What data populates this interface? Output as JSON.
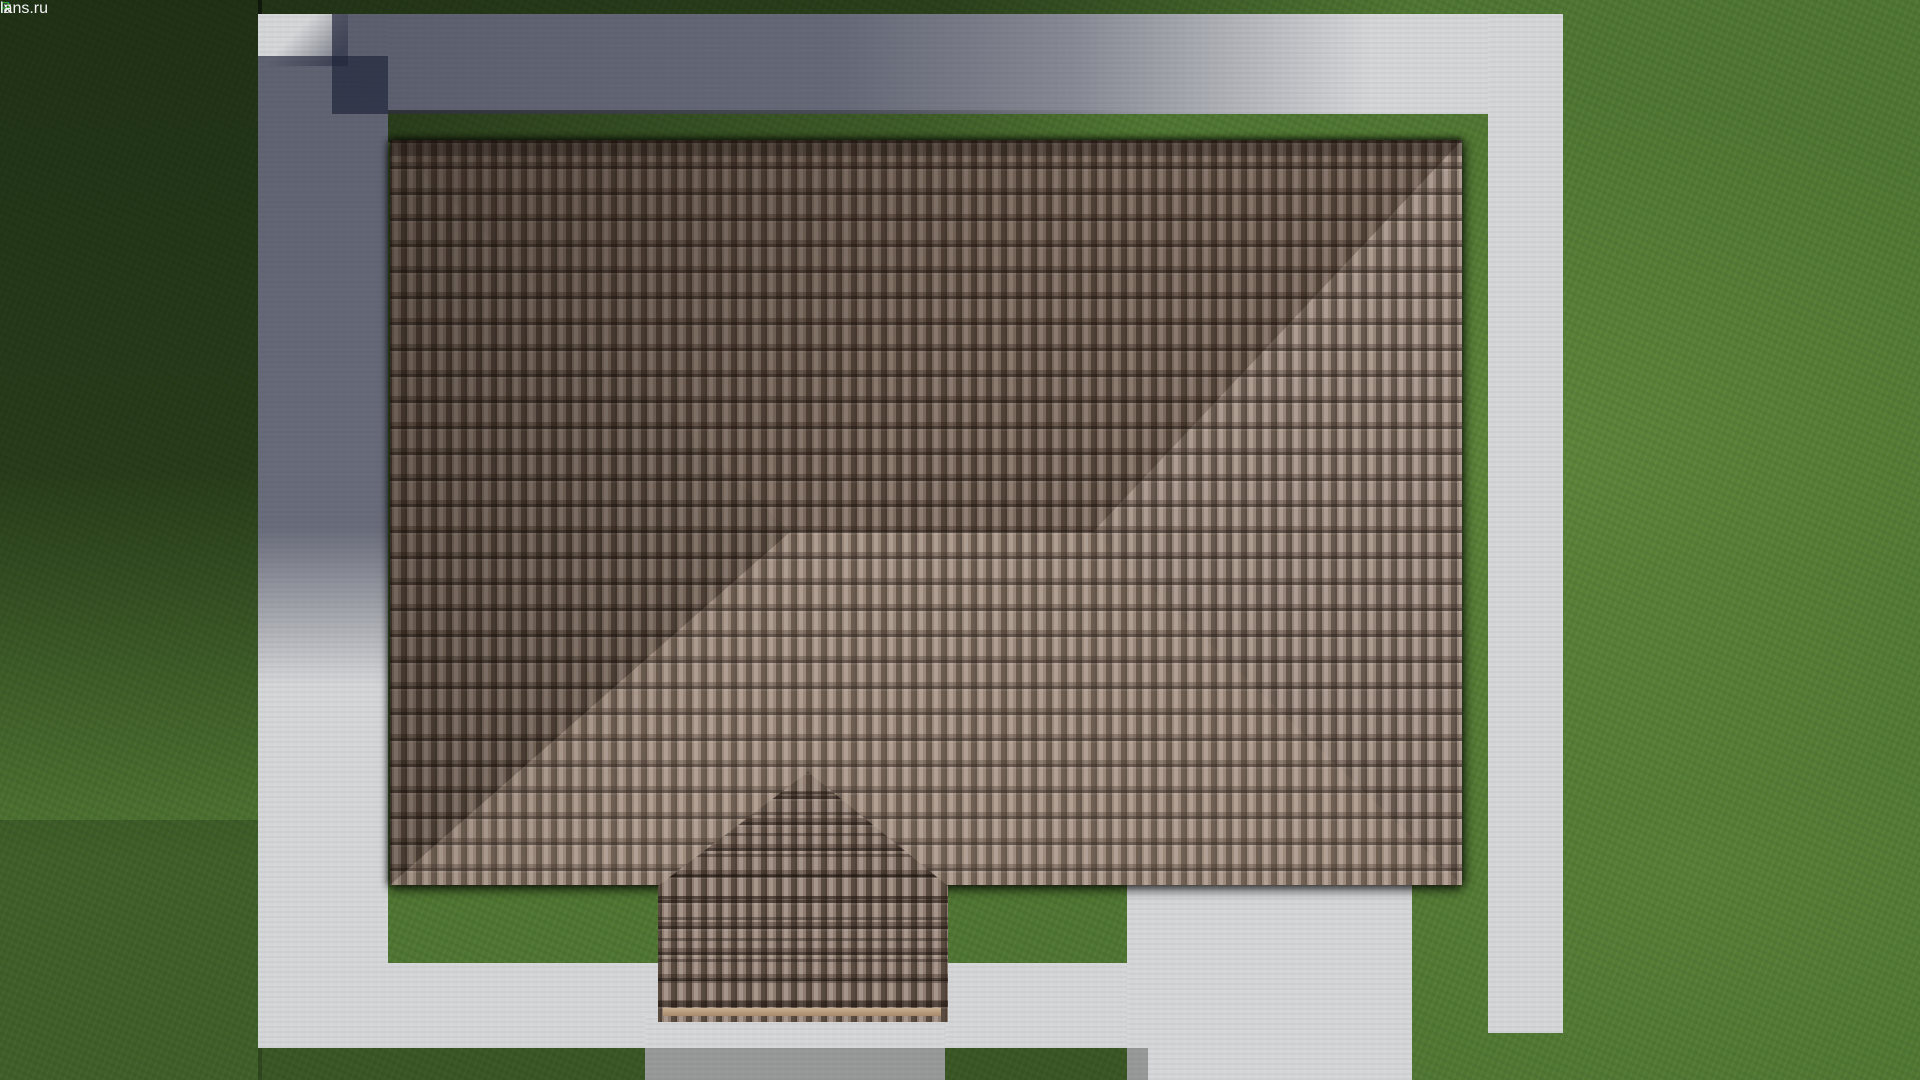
{
  "logo": {
    "part_f": "F",
    "part_ix": "ix",
    "part_p": "P",
    "part_lans_ru": "lans.ru",
    "color_f": "#1e5ede",
    "color_p": "#35a81c",
    "color_rest": "#f2f2f4"
  },
  "scene": {
    "description": "Top-down aerial 3D render of a house hip roof with tiled surface, concrete walkway ring, driveway with black car, lawn, folding rulers and flower beds",
    "palette": {
      "grass": "#4e7531",
      "grass_shadow": "#22391b",
      "concrete_lit": "#d4d5d7",
      "concrete_shadow": "#565c70",
      "roof_tile": "#8d7c6f",
      "roof_tile_dark": "#4f4339",
      "ridge_cap": "#c4ad93",
      "car": "#0b0b0e",
      "ruler_blue": "#2b7de0",
      "ruler_green": "#3fae1e",
      "ruler_white": "#eceff2"
    },
    "objects": {
      "main_roof": "hip roof with central ridge and four hip ridges",
      "porch_roof": "small hip roof projection at bottom center",
      "vent_plate_right_vents": 4,
      "vent_plate_left_vents": 3,
      "car": "black SUV seen from above on driveway, brake light bar visible",
      "rulers": 2,
      "flower_clusters_top": 4,
      "flower_clusters_bottom": 5,
      "flower_cluster_top_right": 1
    }
  }
}
